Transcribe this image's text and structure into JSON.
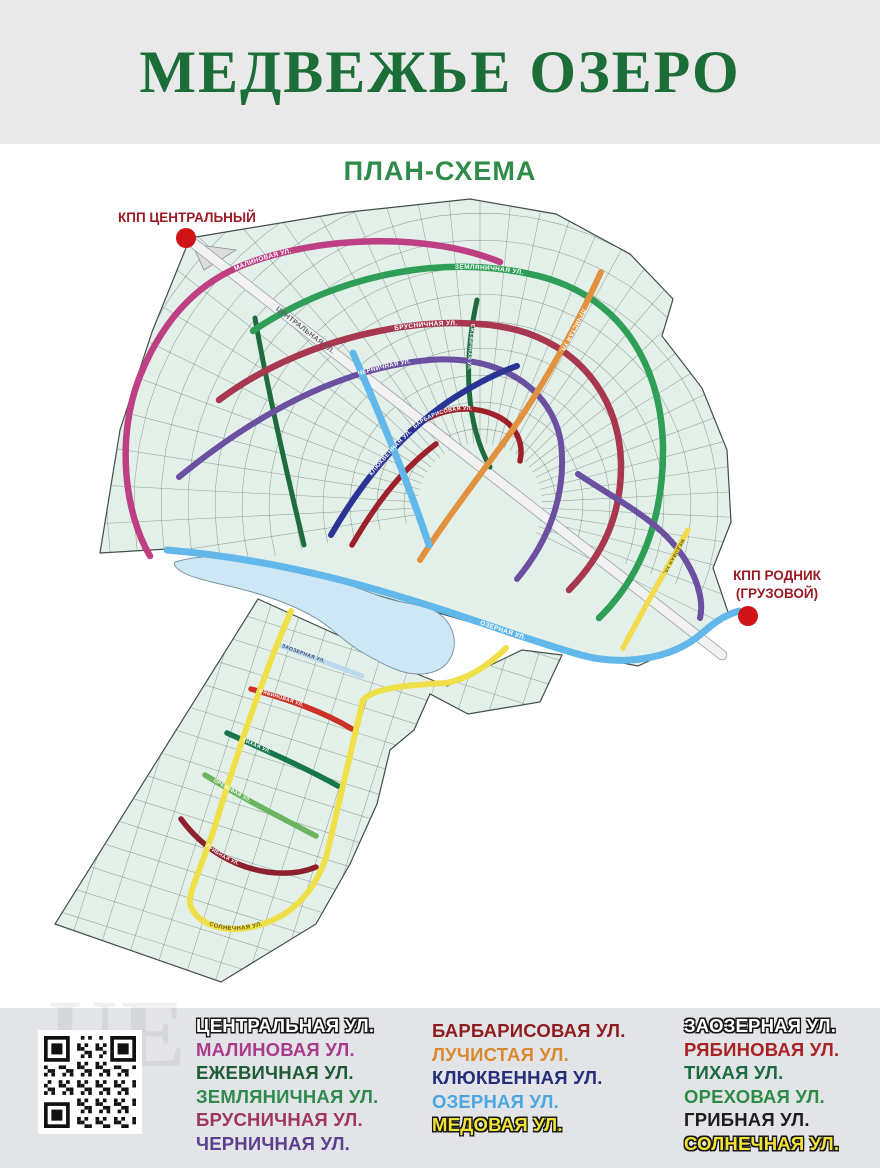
{
  "header": {
    "title": "МЕДВЕЖЬЕ ОЗЕРО",
    "subtitle": "ПЛАН-СХЕМА"
  },
  "checkpoints": {
    "central": {
      "label": "КПП ЦЕНТРАЛЬНЫЙ"
    },
    "rodnik": {
      "label_line1": "КПП РОДНИК",
      "label_line2": "(ГРУЗОВОЙ)"
    }
  },
  "colors": {
    "title": "#1c6e38",
    "subtitle": "#2e8b4a",
    "checkpoint_text": "#9b1b24",
    "checkpoint_dot": "#d01317",
    "parcel_fill": "#e3f0e9",
    "map_outline": "#3f4f46",
    "grid_line": "#50615a",
    "lake_fill": "#cde7f5",
    "lake_outline": "#7b97a8",
    "central_road_fill": "#f2f2f2",
    "central_road_casing": "#9aa5a0",
    "header_band": "#e9e9e9",
    "footer_band": "#e3e4e8"
  },
  "streets": [
    {
      "id": "centralnaya",
      "label": "ЦЕНТРАЛЬНАЯ УЛ.",
      "color": "#f2f2f2",
      "legend_text": "#ffffff",
      "legend_outline": true,
      "map_label_color": "#5a6470"
    },
    {
      "id": "malinovaya",
      "label": "МАЛИНОВАЯ УЛ.",
      "color": "#bf3f85",
      "legend_text": "#a93a8c",
      "map_label_color": "#ffffff"
    },
    {
      "id": "ezhevichnaya",
      "label": "ЕЖЕВИЧНАЯ УЛ.",
      "color": "#1e6b3e",
      "legend_text": "#1e5c34",
      "map_label_color": "#ffffff"
    },
    {
      "id": "zemlyanichnaya",
      "label": "ЗЕМЛЯНИЧНАЯ УЛ.",
      "color": "#2f9e57",
      "legend_text": "#2f8b4c",
      "map_label_color": "#ffffff"
    },
    {
      "id": "brusnichnaya",
      "label": "БРУСНИЧНАЯ УЛ.",
      "color": "#a8374f",
      "legend_text": "#a0355f",
      "map_label_color": "#ffffff"
    },
    {
      "id": "chernichnaya",
      "label": "ЧЕРНИЧНАЯ УЛ.",
      "color": "#6b4fa1",
      "legend_text": "#5c3f8e",
      "map_label_color": "#ffffff"
    },
    {
      "id": "barbarisovaya",
      "label": "БАРБАРИСОВАЯ УЛ.",
      "color": "#9e2129",
      "legend_text": "#8e1d1d",
      "map_label_color": "#ffffff"
    },
    {
      "id": "luchistaya",
      "label": "ЛУЧИСТАЯ УЛ.",
      "color": "#e2923f",
      "legend_text": "#d98a2e",
      "map_label_color": "#ffffff"
    },
    {
      "id": "klyukvennaya",
      "label": "КЛЮКВЕННАЯ УЛ.",
      "color": "#2a3494",
      "legend_text": "#232e7a",
      "map_label_color": "#ffffff"
    },
    {
      "id": "ozernaya",
      "label": "ОЗЕРНАЯ УЛ.",
      "color": "#62b8ea",
      "legend_text": "#4aa7e0",
      "map_label_color": "#ffffff"
    },
    {
      "id": "medovaya",
      "label": "МЕДОВАЯ УЛ.",
      "color": "#f2dc4e",
      "legend_text": "#f2e435",
      "legend_outline": true,
      "map_label_color": "#6b5c12"
    },
    {
      "id": "zaozernaya",
      "label": "ЗАОЗЕРНАЯ УЛ.",
      "color": "#bcd9ee",
      "legend_text": "#ffffff",
      "legend_outline": true,
      "map_label_color": "#3a4a66"
    },
    {
      "id": "ryabinovaya",
      "label": "РЯБИНОВАЯ УЛ.",
      "color": "#cc3326",
      "legend_text": "#a82323",
      "map_label_color": "#ffffff"
    },
    {
      "id": "tihaya",
      "label": "ТИХАЯ УЛ.",
      "color": "#18764c",
      "legend_text": "#1a6b3e",
      "map_label_color": "#ffffff"
    },
    {
      "id": "orehovaya",
      "label": "ОРЕХОВАЯ УЛ.",
      "color": "#6ab55e",
      "legend_text": "#2e8b43",
      "map_label_color": "#ffffff"
    },
    {
      "id": "gribnaya",
      "label": "ГРИБНАЯ УЛ.",
      "color": "#8e1f2c",
      "legend_text": "#1d1d1d",
      "map_label_color": "#ffffff"
    },
    {
      "id": "solnechnaya",
      "label": "СОЛНЕЧНАЯ УЛ.",
      "color": "#efe04a",
      "legend_text": "#f2e435",
      "legend_outline": true,
      "map_label_color": "#6b5c12"
    }
  ],
  "legend": {
    "columns": [
      [
        "centralnaya",
        "malinovaya",
        "ezhevichnaya",
        "zemlyanichnaya",
        "brusnichnaya",
        "chernichnaya"
      ],
      [
        "barbarisovaya",
        "luchistaya",
        "klyukvennaya",
        "ozernaya",
        "medovaya"
      ],
      [
        "zaozernaya",
        "ryabinovaya",
        "tihaya",
        "orehovaya",
        "gribnaya",
        "solnechnaya"
      ]
    ]
  },
  "watermark": "UE"
}
